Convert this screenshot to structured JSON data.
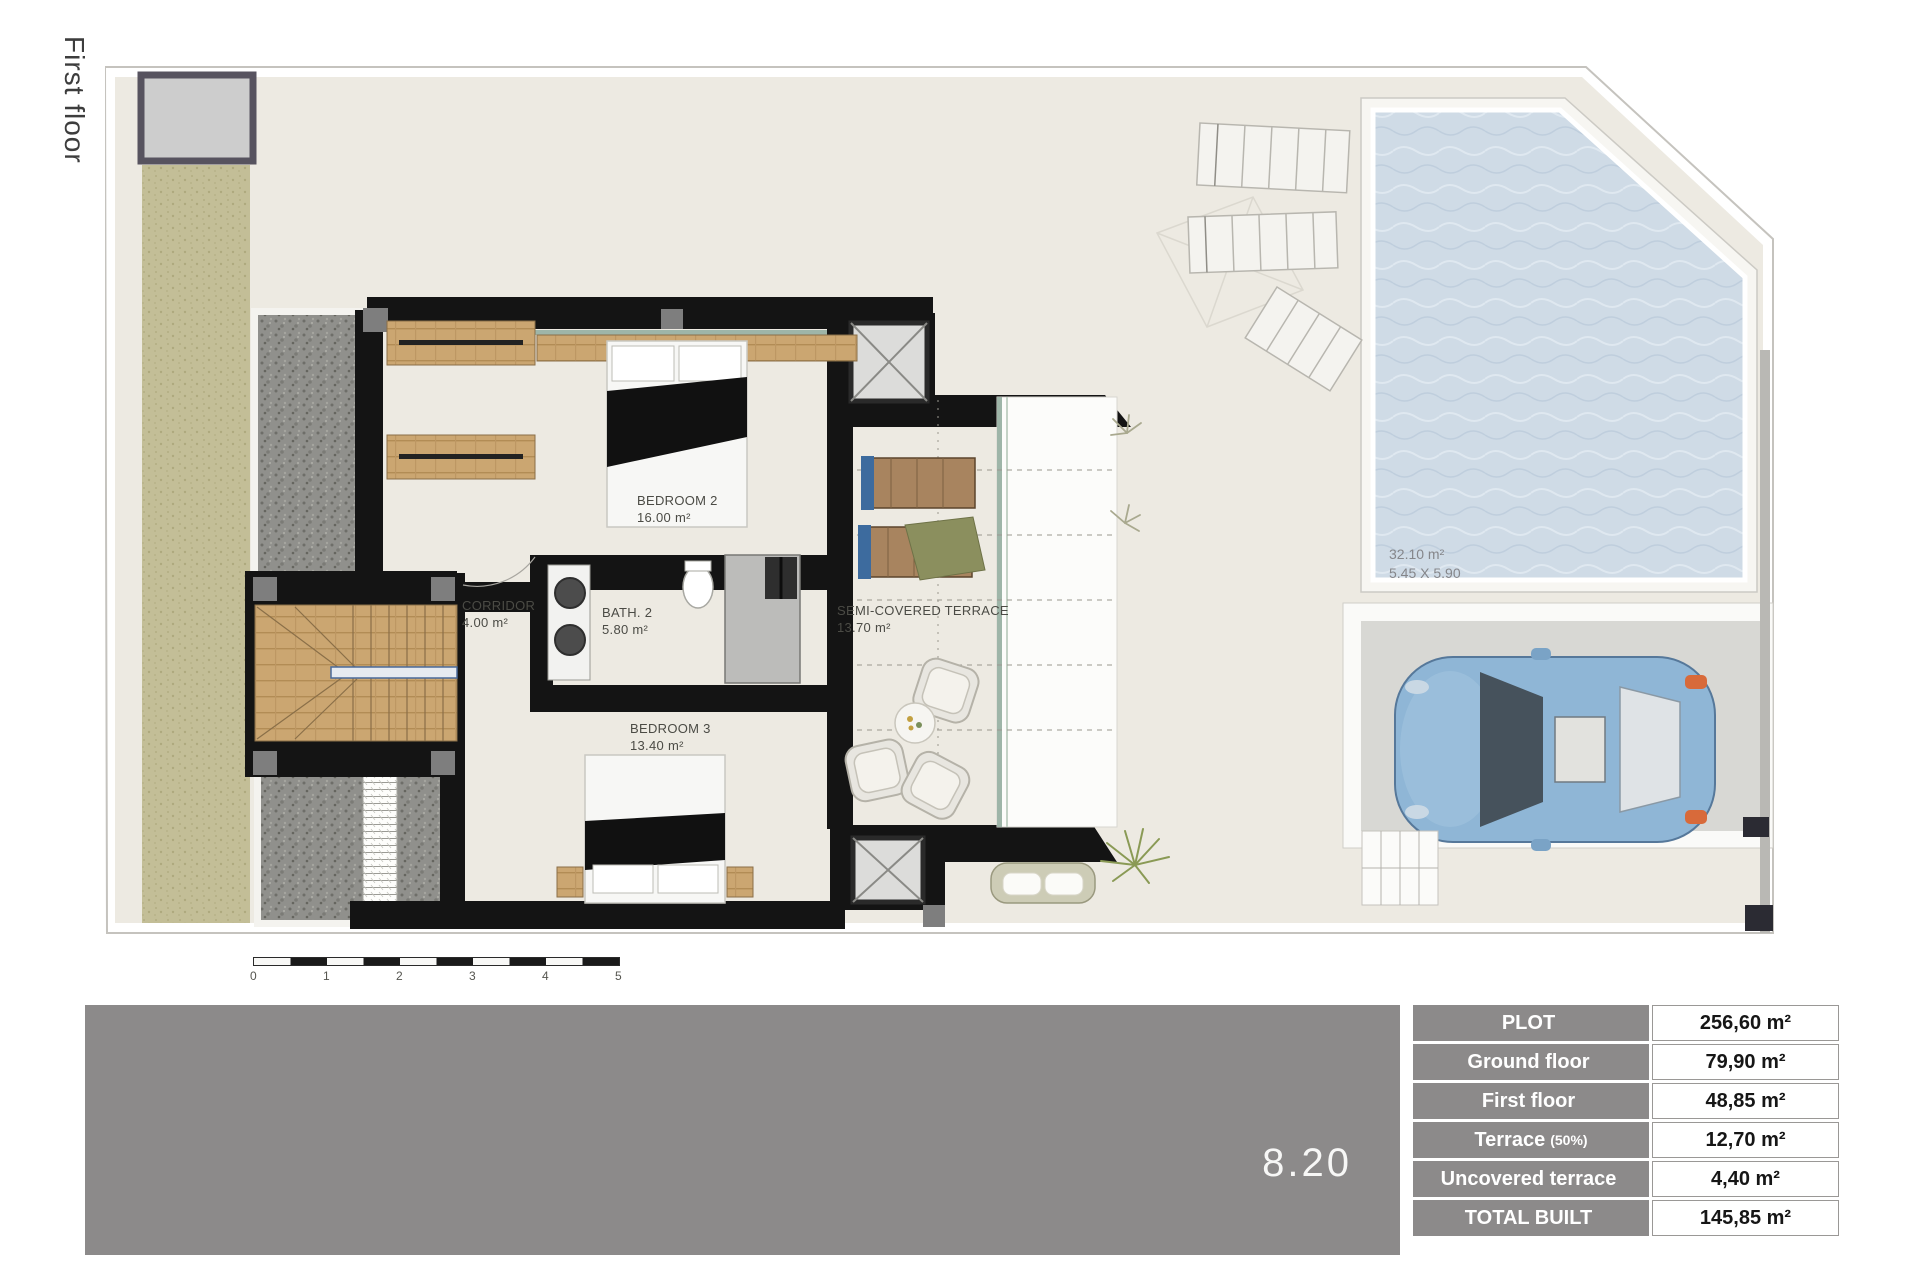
{
  "header": {
    "floor_label": "First floor"
  },
  "plan": {
    "rooms": [
      {
        "name": "BEDROOM 2",
        "area": "16.00 m²"
      },
      {
        "name": "CORRIDOR",
        "area": "4.00 m²"
      },
      {
        "name": "BATH. 2",
        "area": "5.80 m²"
      },
      {
        "name": "BEDROOM 3",
        "area": "13.40 m²"
      },
      {
        "name": "SEMI-COVERED TERRACE",
        "area": "13.70 m²"
      }
    ],
    "pool": {
      "area": "32.10 m²",
      "dimensions": "5.45 X 5.90"
    },
    "scale": {
      "labels": [
        "0",
        "1",
        "2",
        "3",
        "4",
        "5"
      ]
    }
  },
  "footer": {
    "plan_number": "8.20"
  },
  "summary_table": {
    "rows": [
      {
        "label": "PLOT",
        "suffix": "",
        "value": "256,60 m²"
      },
      {
        "label": "Ground floor",
        "suffix": "",
        "value": "79,90 m²"
      },
      {
        "label": "First floor",
        "suffix": "",
        "value": "48,85 m²"
      },
      {
        "label": "Terrace",
        "suffix": "(50%)",
        "value": "12,70 m²"
      },
      {
        "label": "Uncovered terrace",
        "suffix": "",
        "value": "4,40 m²"
      },
      {
        "label": "TOTAL BUILT",
        "suffix": "",
        "value": "145,85 m²"
      }
    ]
  },
  "colors": {
    "accent_gray": "#8c8a8a",
    "pool_blue": "#cfdbe6",
    "grass_green": "#c3be97",
    "wall_black": "#141414"
  }
}
